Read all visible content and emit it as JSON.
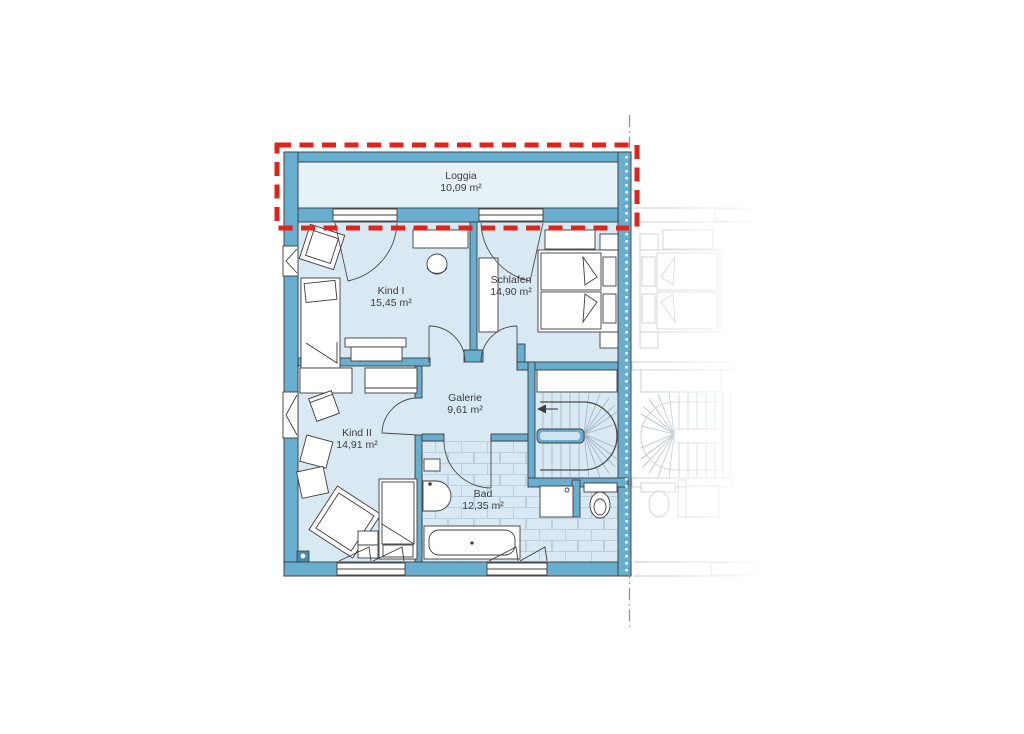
{
  "floor_plan": {
    "title": "Obergeschoss Doppelhaus Grundriss",
    "rooms": [
      {
        "name": "Loggia",
        "area": "10,09 m²"
      },
      {
        "name": "Kind I",
        "area": "15,45 m²"
      },
      {
        "name": "Schlafen",
        "area": "14,90 m²"
      },
      {
        "name": "Kind II",
        "area": "14,91 m²"
      },
      {
        "name": "Galerie",
        "area": "9,61 m²"
      },
      {
        "name": "Bad",
        "area": "12,35 m²"
      }
    ],
    "colors": {
      "wall": "#68aecf",
      "room_floor": "#d9e9f4",
      "loggia_floor": "#e7f1f8",
      "tile_line": "#b7d1e3",
      "outline": "#3c3c3c",
      "highlight_red": "#e2231a",
      "neighbor_gray": "#c6c6c6",
      "boundary_gray": "#8f8f8f"
    }
  }
}
